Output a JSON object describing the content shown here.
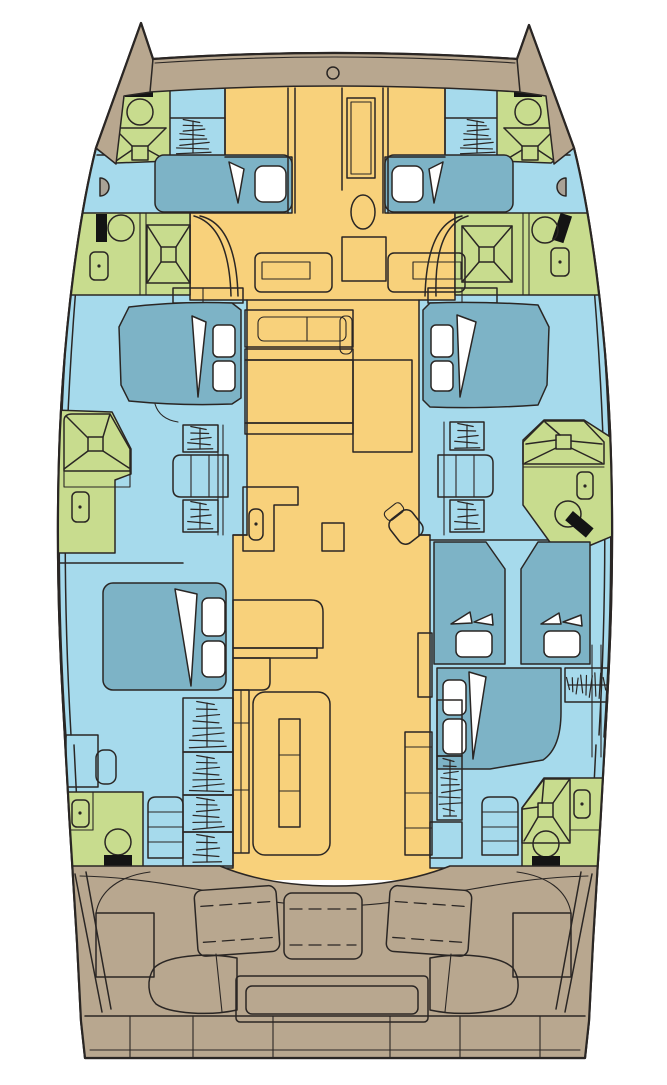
{
  "diagram": {
    "kind": "yacht-floor-plan",
    "vessel_shape": "catamaran",
    "visible_text": [],
    "colors": {
      "background": "#ffffff",
      "outline": "#2a2624",
      "deck": "#b8a78f",
      "salon": "#f8d17b",
      "cabin_floor": "#a6daec",
      "bed": "#7db3c6",
      "bathroom": "#c8dc8e",
      "fixture_white": "#ffffff",
      "fixture_black": "#141414",
      "fixture_gray": "#a9a296"
    },
    "areas": [
      {
        "id": "foredeck",
        "role": "deck",
        "fixtures": [
          "deck-hatch"
        ]
      },
      {
        "id": "port-bow-head",
        "role": "bathroom",
        "fixtures": [
          "toilet",
          "shower"
        ]
      },
      {
        "id": "starboard-bow-head",
        "role": "bathroom",
        "fixtures": [
          "toilet",
          "shower"
        ]
      },
      {
        "id": "port-bow-cabin",
        "role": "cabin",
        "fixtures": [
          "double-berth",
          "companionway-steps"
        ]
      },
      {
        "id": "starboard-bow-cabin",
        "role": "cabin",
        "fixtures": [
          "double-berth",
          "companionway-steps"
        ]
      },
      {
        "id": "port-forward-head",
        "role": "bathroom",
        "fixtures": [
          "toilet",
          "sink",
          "shower"
        ]
      },
      {
        "id": "starboard-forward-head",
        "role": "bathroom",
        "fixtures": [
          "toilet",
          "sink",
          "shower"
        ]
      },
      {
        "id": "salon",
        "role": "salon",
        "fixtures": [
          "cabinet-column",
          "oval-fixture",
          "square-table",
          "bench-console",
          "bench-console",
          "galley-counter",
          "galley-island",
          "nav-table",
          "chair",
          "l-shaped-galley",
          "sink",
          "settee-with-table",
          "side-cabinets",
          "stool"
        ]
      },
      {
        "id": "port-midship-cabin",
        "role": "cabin",
        "fixtures": [
          "double-berth",
          "companionway-steps",
          "step-treads"
        ]
      },
      {
        "id": "starboard-midship-cabin",
        "role": "cabin",
        "fixtures": [
          "double-berth",
          "companionway-steps",
          "step-treads"
        ]
      },
      {
        "id": "port-midship-head",
        "role": "bathroom",
        "fixtures": [
          "shower",
          "sink"
        ]
      },
      {
        "id": "starboard-midship-head",
        "role": "bathroom",
        "fixtures": [
          "shower",
          "sink",
          "toilet"
        ]
      },
      {
        "id": "port-aft-cabin",
        "role": "cabin",
        "fixtures": [
          "double-berth",
          "desk",
          "seat",
          "companionway-steps",
          "step-treads"
        ]
      },
      {
        "id": "starboard-aft-cabin",
        "role": "cabin",
        "fixtures": [
          "single-berth",
          "single-berth",
          "double-berth",
          "hanging-locker",
          "companionway-steps",
          "step-treads"
        ]
      },
      {
        "id": "port-aft-head",
        "role": "bathroom",
        "fixtures": [
          "sink",
          "toilet"
        ]
      },
      {
        "id": "starboard-aft-head",
        "role": "bathroom",
        "fixtures": [
          "shower",
          "sink",
          "toilet"
        ]
      },
      {
        "id": "cockpit",
        "role": "deck",
        "fixtures": [
          "bench-cushion",
          "bench-cushion",
          "bench-cushion",
          "cockpit-table",
          "kidney-seat",
          "kidney-seat",
          "side-locker",
          "side-locker"
        ]
      },
      {
        "id": "transom",
        "role": "deck",
        "fixtures": [
          "swim-platform-steps"
        ]
      }
    ],
    "inventory": {
      "double_berths": 6,
      "single_berths": 2,
      "toilets": 7,
      "sinks": 7,
      "showers": 6,
      "companionway_step_flights": 9,
      "hanging_lockers": 1,
      "cockpit_bench_cushions": 3,
      "cockpit_tables": 1
    }
  }
}
